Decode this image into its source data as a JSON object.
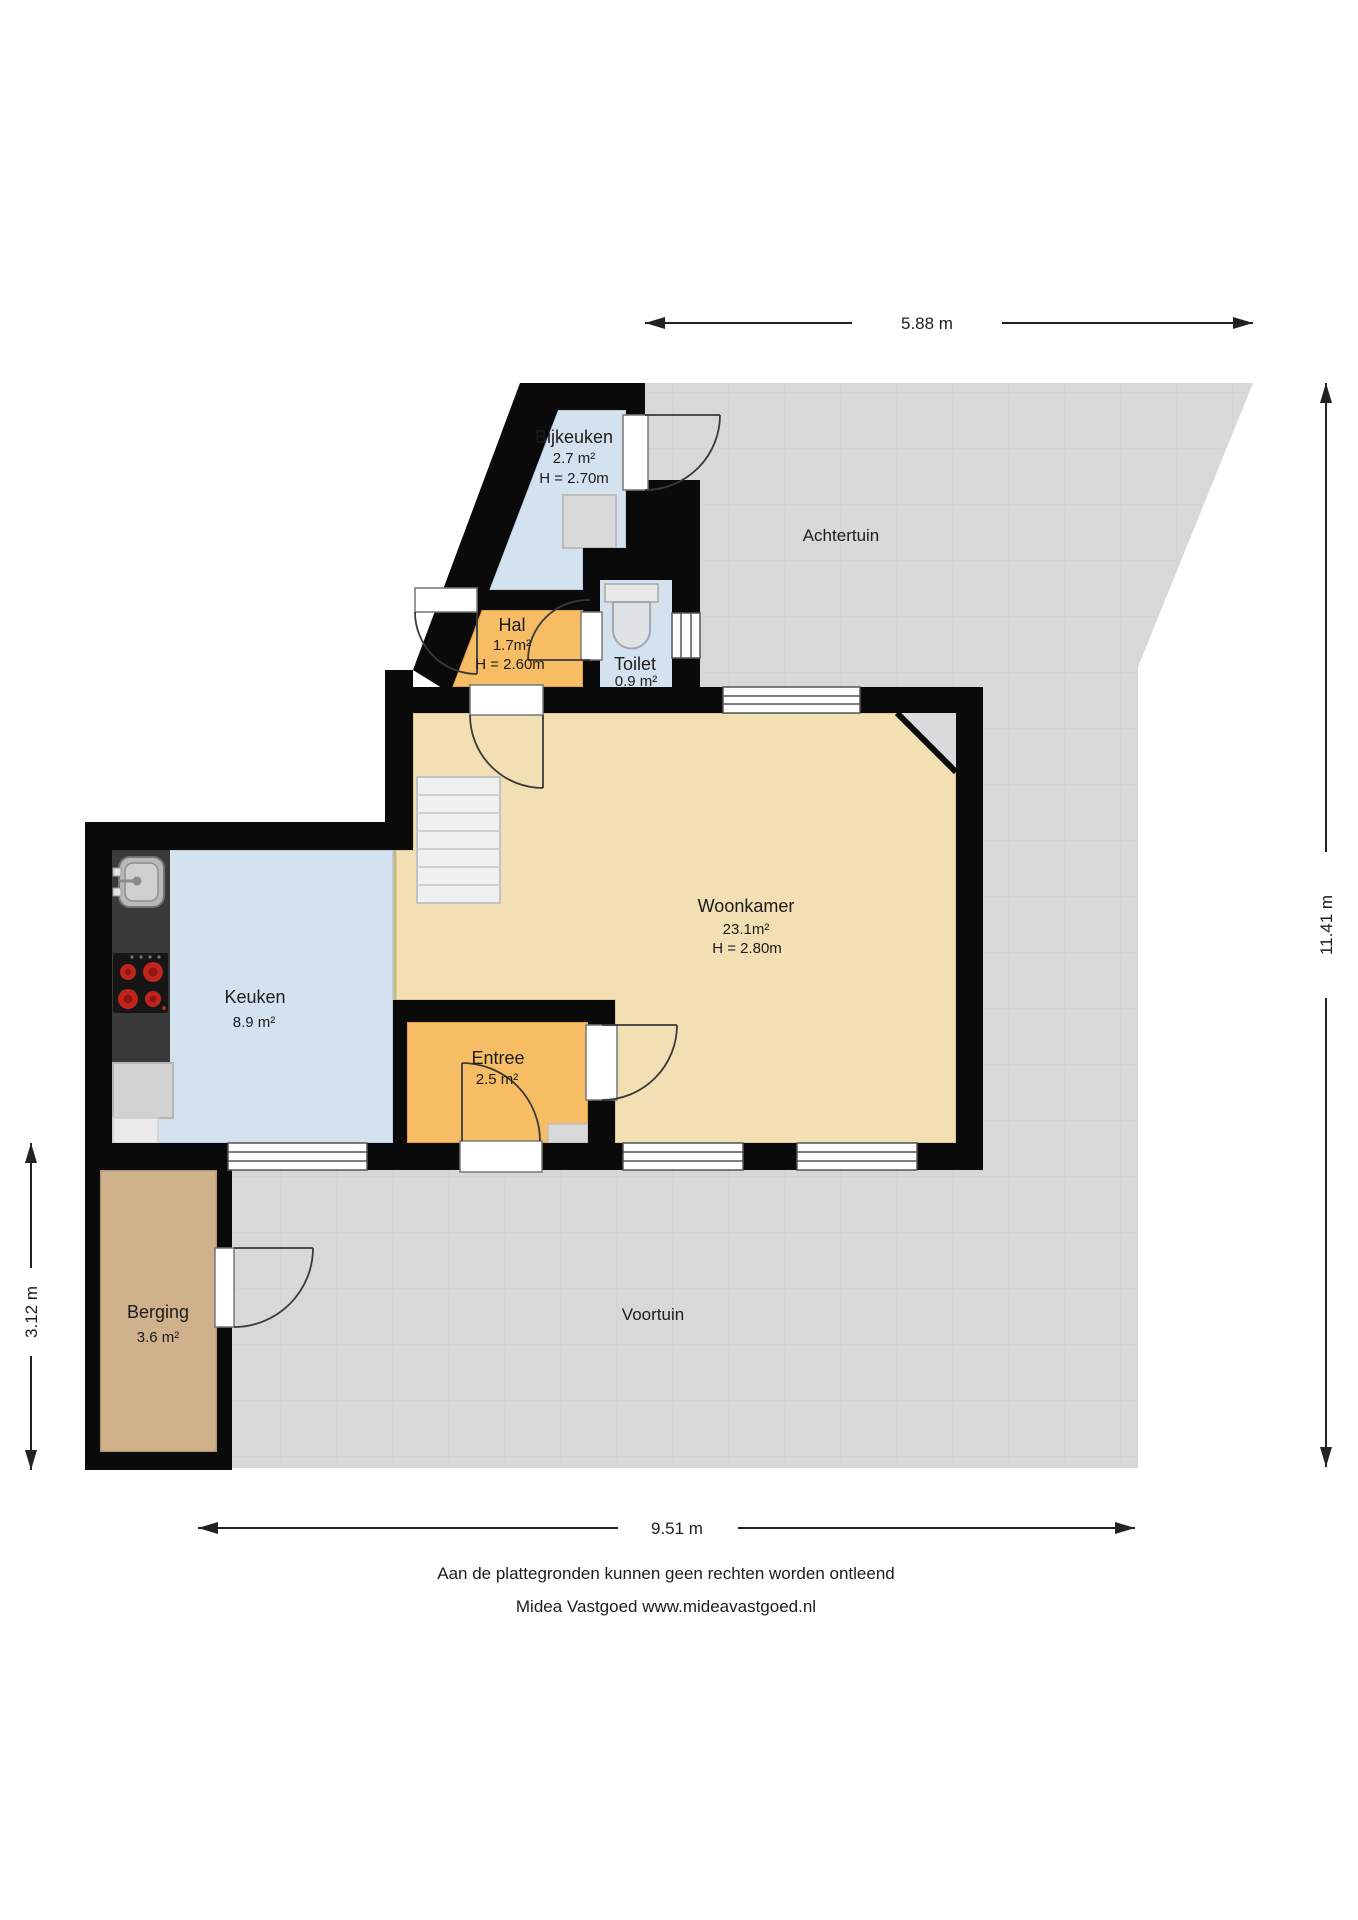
{
  "plan": {
    "rooms": [
      {
        "name": "Bijkeuken",
        "area": "2.7 m²",
        "height": "H = 2.70m"
      },
      {
        "name": "Hal",
        "area": "1.7m²",
        "height": "H = 2.60m"
      },
      {
        "name": "Toilet",
        "area": "0.9 m²",
        "height": ""
      },
      {
        "name": "Woonkamer",
        "area": "23.1m²",
        "height": "H = 2.80m"
      },
      {
        "name": "Keuken",
        "area": "8.9 m²",
        "height": ""
      },
      {
        "name": "Entree",
        "area": "2.5 m²",
        "height": ""
      },
      {
        "name": "Berging",
        "area": "3.6 m²",
        "height": ""
      }
    ],
    "gardens": [
      {
        "name": "Achtertuin"
      },
      {
        "name": "Voortuin"
      }
    ],
    "dimensions": {
      "top": "5.88 m",
      "right": "11.41 m",
      "left": "3.12 m",
      "bottom": "9.51 m"
    },
    "footer": {
      "line1": "Aan de plattegronden kunnen geen rechten worden ontleend",
      "line2": "Midea Vastgoed www.mideavastgoed.nl"
    },
    "colors": {
      "wall": "#0a0a0a",
      "garden": "#d8d8d8",
      "blue_room": "#d4e2f0",
      "orange_room": "#f6bd64",
      "beige_room": "#f3dfb4",
      "tan_room": "#cfb28c",
      "counter": "#3a3a3a",
      "burner": "#c0251c",
      "stairs": "#efefef",
      "dimension_line": "#222222"
    }
  }
}
